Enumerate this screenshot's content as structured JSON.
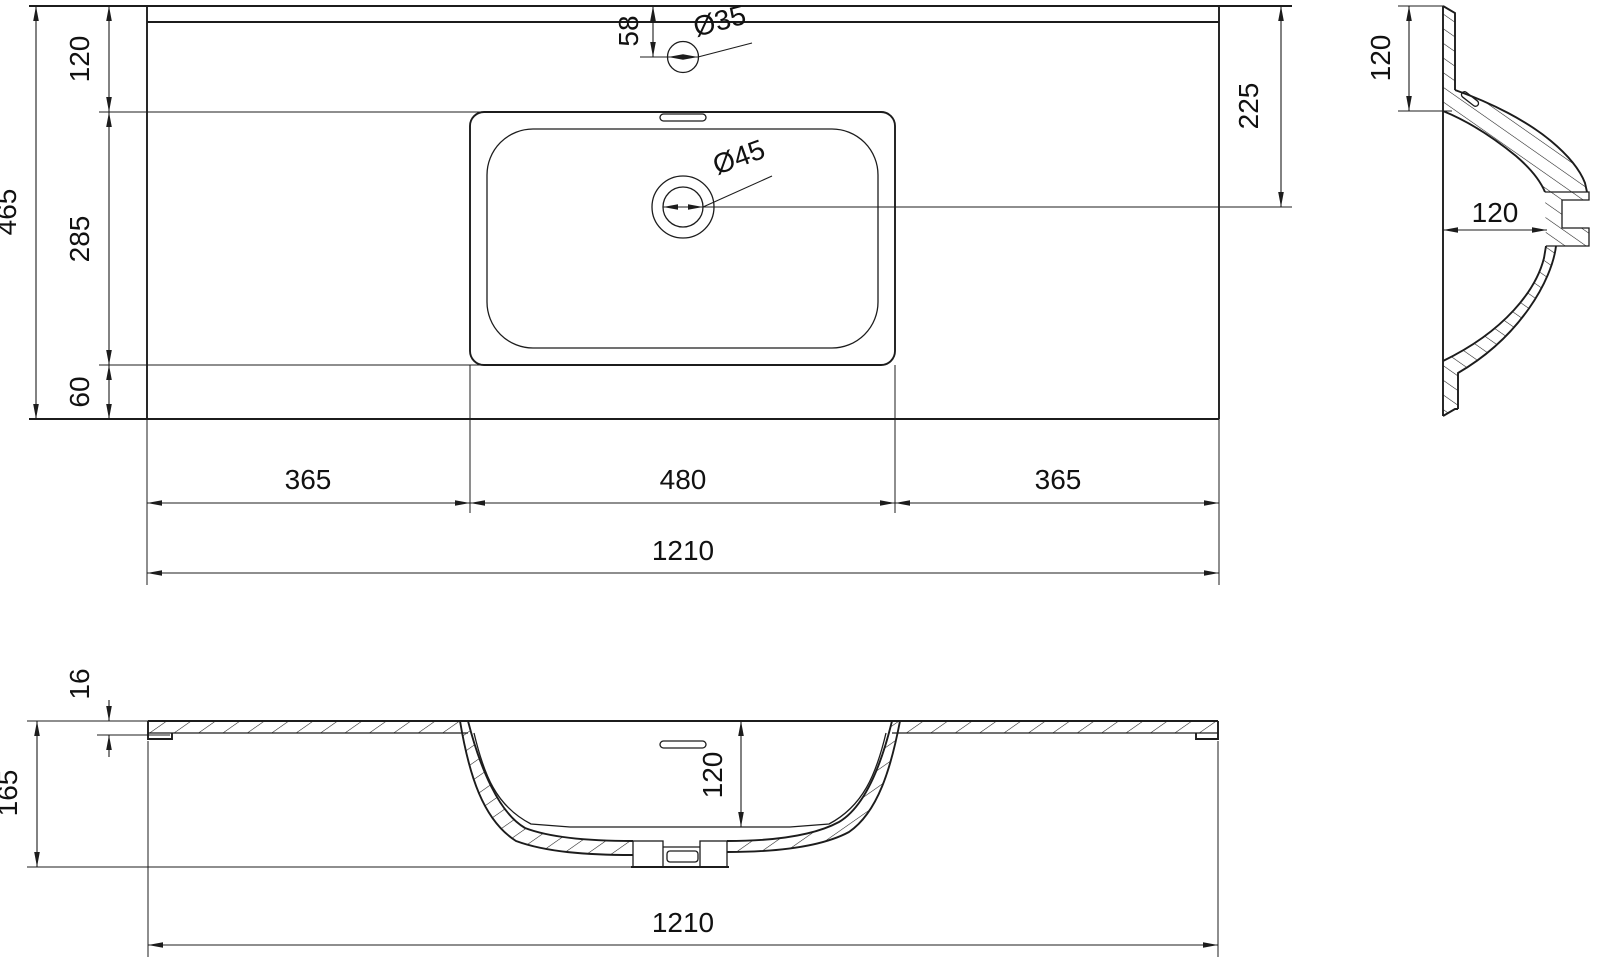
{
  "drawing": {
    "plan": {
      "depth_total": "465",
      "seg_back": "120",
      "seg_basin": "285",
      "seg_front": "60",
      "faucet_offset": "58",
      "faucet_dia": "Ø35",
      "drain_dia": "Ø45",
      "drain_from_back": "225",
      "width_left": "365",
      "width_center": "480",
      "width_right": "365",
      "width_total": "1210"
    },
    "side": {
      "shelf_depth": "120",
      "bowl_height": "120"
    },
    "front": {
      "slab_thickness": "16",
      "total_height": "165",
      "bowl_depth": "120",
      "width_total": "1210"
    },
    "line_color": "#1c1c1c",
    "background": "#ffffff"
  }
}
